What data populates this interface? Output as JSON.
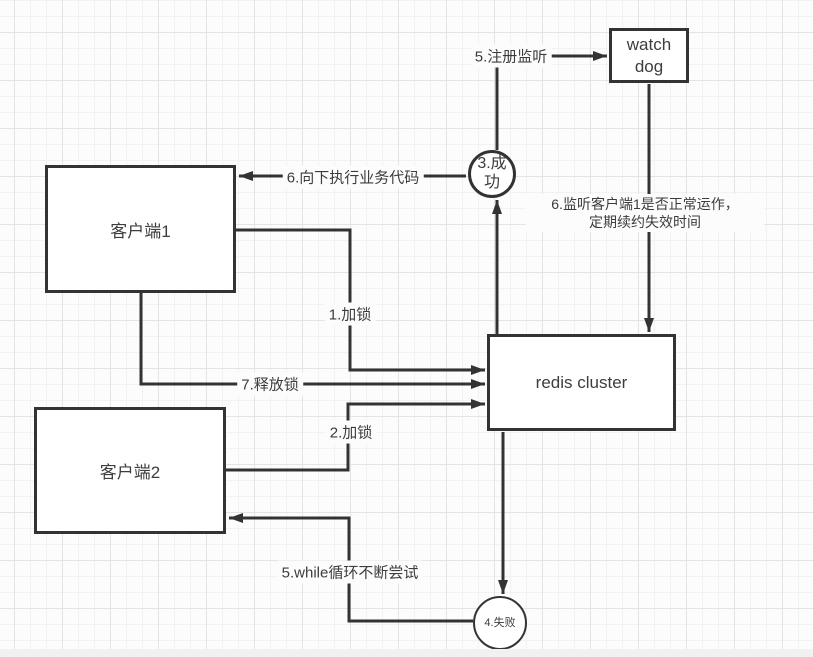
{
  "canvas": {
    "background": "#fcfcfc",
    "grid_minor_color": "#f2f2f2",
    "grid_major_color": "#e4e4e4",
    "stroke_color": "#333333",
    "text_color": "#3c3c3c"
  },
  "nodes": {
    "client1": {
      "label": "客户端1"
    },
    "client2": {
      "label": "客户端2"
    },
    "redis": {
      "label": "redis cluster"
    },
    "watchdog": {
      "label": "watch dog"
    },
    "success": {
      "label": "3.成功"
    },
    "failure": {
      "label": "4.失败"
    }
  },
  "edge_labels": {
    "register": "5.注册监听",
    "exec_business": "6.向下执行业务代码",
    "monitor_line1": "6.监听客户端1是否正常运作，",
    "monitor_line2": "定期续约失效时间",
    "lock1": "1.加锁",
    "release": "7.释放锁",
    "lock2": "2.加锁",
    "while_retry": "5.while循环不断尝试"
  }
}
